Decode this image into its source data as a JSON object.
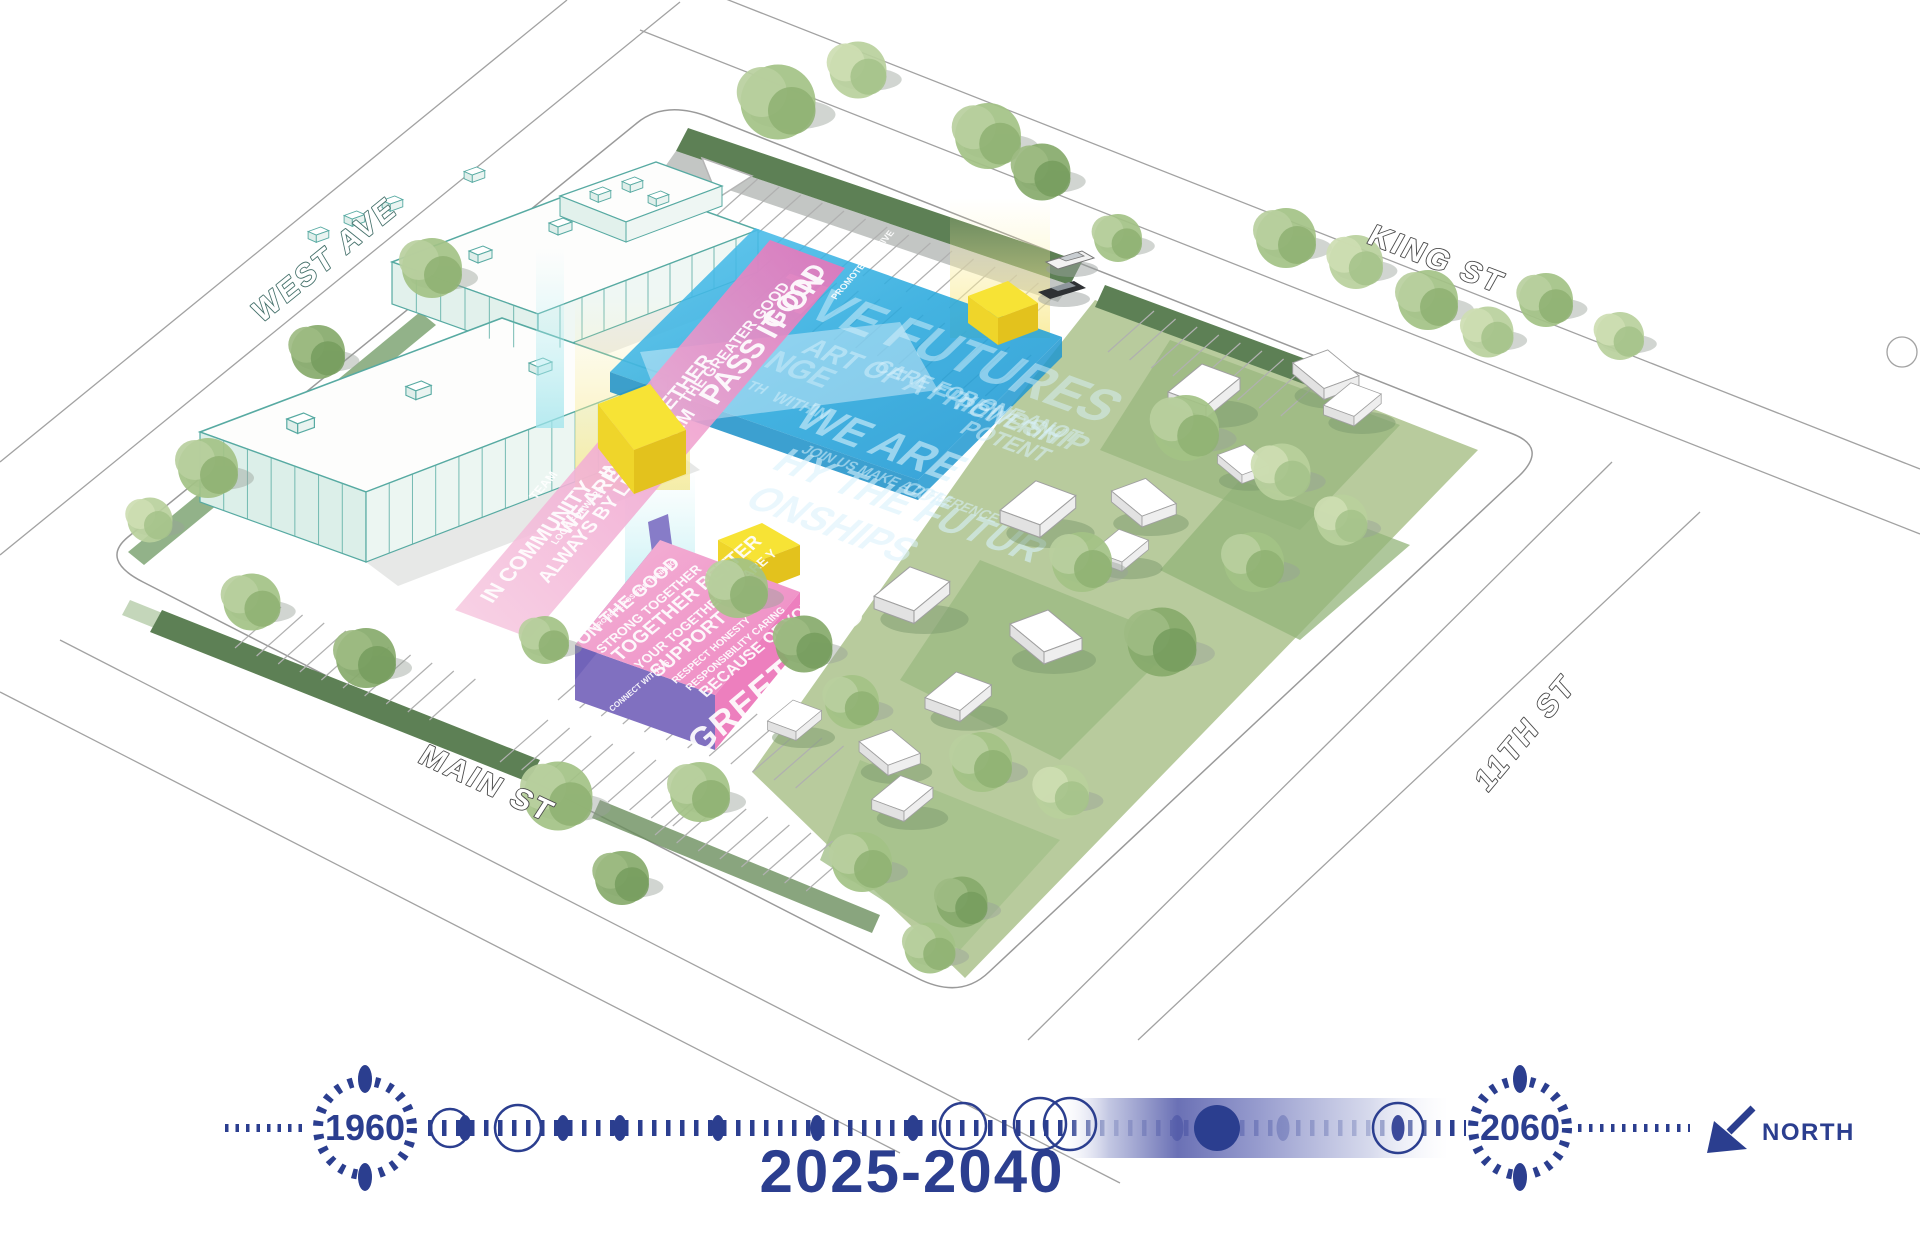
{
  "diagram": {
    "type": "axonometric-site-phasing-diagram",
    "phase_label": "2025-2040"
  },
  "streets": {
    "west_ave": "WEST AVE",
    "king_st": "KING ST",
    "main_st": "MAIN ST",
    "eleventh_st": "11TH ST"
  },
  "timeline": {
    "start_year": "1960",
    "end_year": "2060",
    "phase": "2025-2040",
    "north": "NORTH"
  },
  "blue_volume": {
    "words": [
      "TIVE FUTURES",
      "ART OF A FRIENDSHIP",
      "NGE",
      "CARE FOR ONE ANOT",
      "WE ARE",
      "POWERIN",
      "POTENT",
      "HY THE FUTUR",
      "JOIN US MAKE A DIFFERENCE",
      "ONSHIPS",
      "WITHIN",
      "TH",
      "COM"
    ]
  },
  "pink_ribbon": {
    "words": [
      "IN COMMUNITY",
      "WE ARE",
      "ALWAYS BY LEARN FAM",
      "IN IT TOGETHER",
      "THE GREATER GOOD",
      "PASS IT ON",
      "GOOD",
      "LOOK FORWARD",
      "TEAM",
      "PROMOTE POSITIVE"
    ]
  },
  "pink_box": {
    "top_words": [
      "ON THE GOOD",
      "STRONG TOGETHER",
      "TOGETHER BETTER",
      "YOUR TOGETHER WE ARE Y",
      "SUPPORT",
      "RESPECT HONESTY",
      "RESPONSIBILITY CARING",
      "BECAUSE OF YOU",
      "PROMOTE POSITIVE THINKING"
    ],
    "front_word": "GREETINGS",
    "side_word": "CONNECT WITH US"
  },
  "colors": {
    "accent_navy": "#2b3e8f",
    "volume_blue": "#29a8dc",
    "volume_pink": "#ee8ec6",
    "volume_purple": "#8374c4",
    "volume_yellow": "#f8e93c",
    "landscape_green": "#5d7f54",
    "lawn_green": "#b8cb9d",
    "teal_outline": "#4aa49b"
  }
}
